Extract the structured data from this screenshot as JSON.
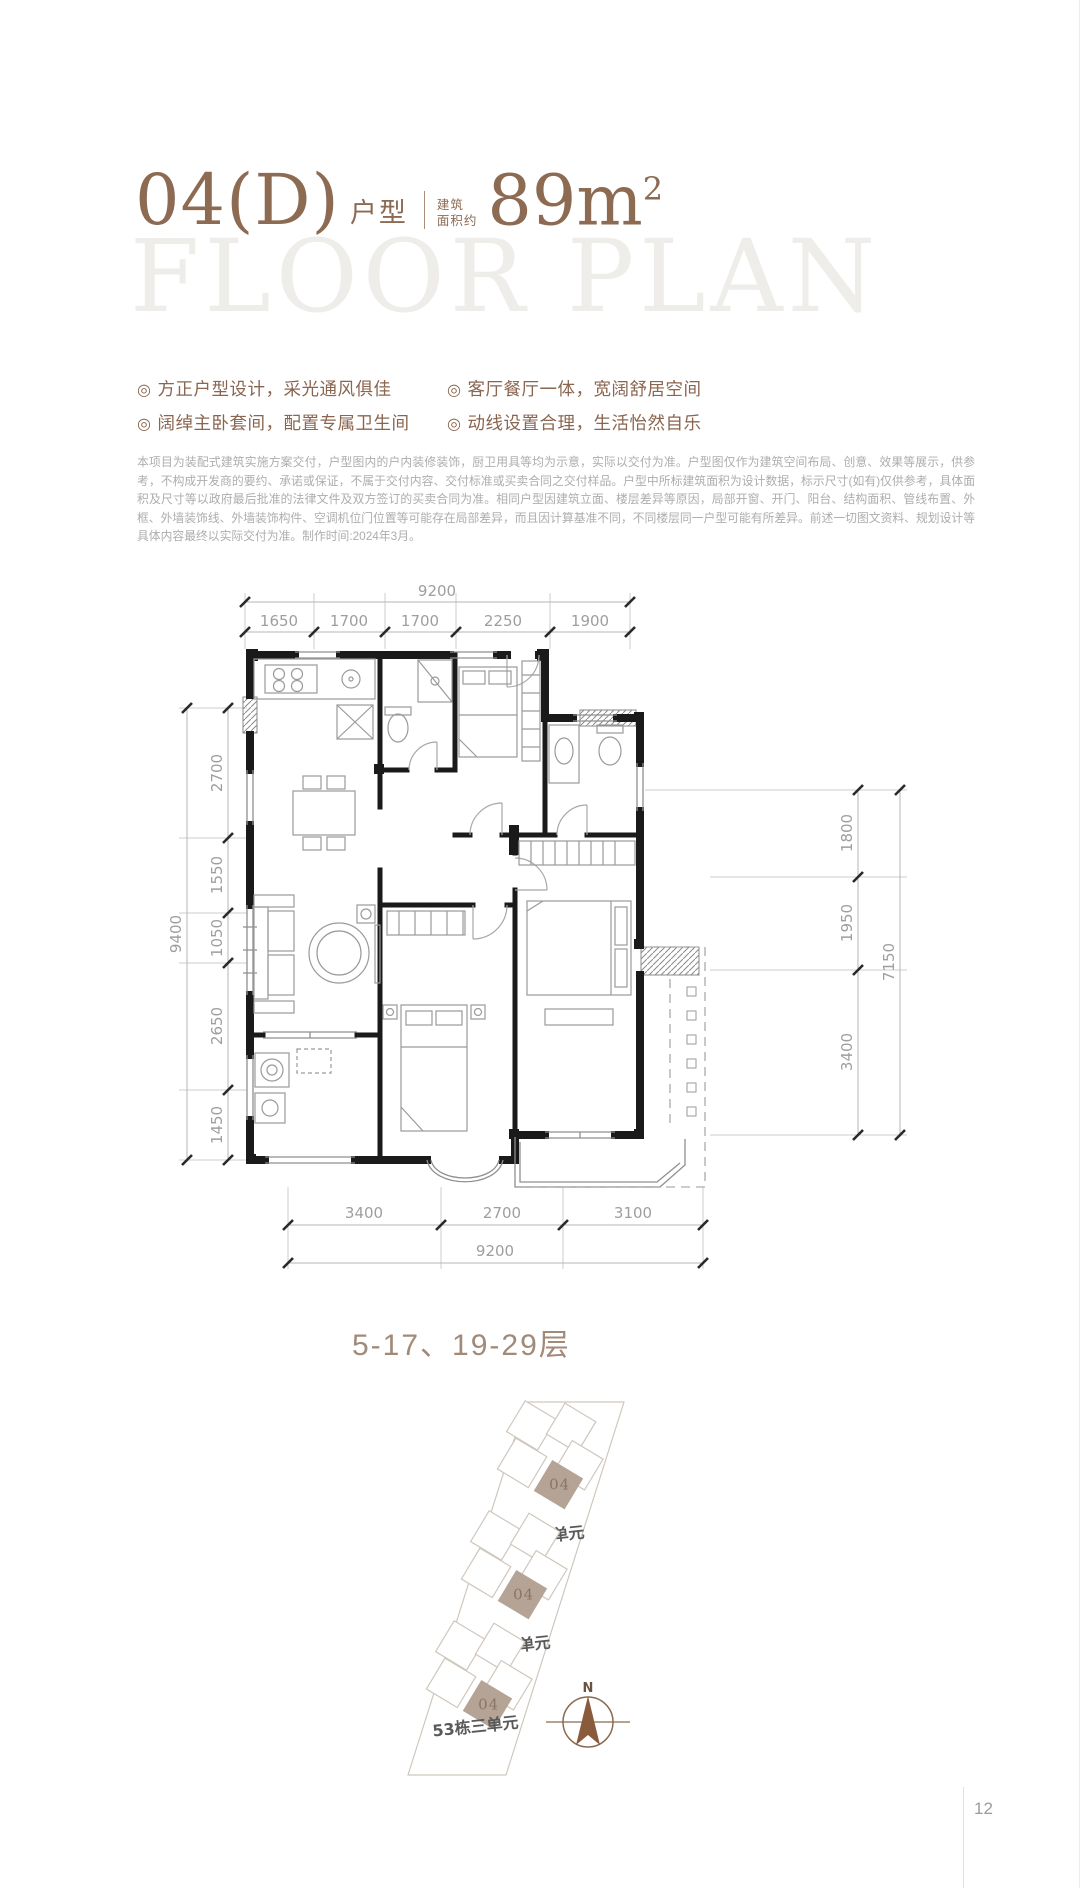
{
  "header": {
    "unit_code": "04(D)",
    "unit_type_label": "户型",
    "area_label_line1": "建筑",
    "area_label_line2": "面积约",
    "area_value": "89m",
    "area_superscript": "2"
  },
  "watermark": "FLOOR PLAN",
  "bullet_glyph": "◎",
  "features": [
    "方正户型设计，采光通风俱佳",
    "客厅餐厅一体，宽阔舒居空间",
    "阔绰主卧套间，配置专属卫生间",
    "动线设置合理，生活怡然自乐"
  ],
  "disclaimer": "本项目为装配式建筑实施方案交付，户型图内的户内装修装饰，厨卫用具等均为示意，实际以交付为准。户型图仅作为建筑空间布局、创意、效果等展示，供参考，不构成开发商的要约、承诺或保证，不属于交付内容、交付标准或买卖合同之交付样品。户型中所标建筑面积为设计数据，标示尺寸(如有)仅供参考，具体面积及尺寸等以政府最后批准的法律文件及双方签订的买卖合同为准。相同户型因建筑立面、楼层差异等原因，局部开窗、开门、阳台、结构面积、管线布置、外框、外墙装饰线、外墙装饰构件、空调机位门位置等可能存在局部差异，而且因计算基准不同，不同楼层同一户型可能有所差异。前述一切图文资料、规划设计等具体内容最终以实际交付为准。制作时间:2024年3月。",
  "dimensions": {
    "top": {
      "overall": "9200",
      "segments": [
        "1650",
        "1700",
        "1700",
        "2250",
        "1900"
      ]
    },
    "left": {
      "overall": "9400",
      "segments": [
        "2700",
        "1550",
        "1050",
        "2650",
        "1450"
      ]
    },
    "right": {
      "overall": "7150",
      "segments": [
        "1800",
        "1950",
        "3400"
      ]
    },
    "bottom": {
      "overall": "9200",
      "segments": [
        "3400",
        "2700",
        "3100"
      ]
    }
  },
  "floors_label": "5-17、19-29层",
  "site_plan": {
    "compass_label": "N",
    "units": [
      {
        "unit": "04",
        "caption": "53栋一单元"
      },
      {
        "unit": "04",
        "caption": "53栋二单元"
      },
      {
        "unit": "04",
        "caption": "53栋三单元"
      }
    ]
  },
  "page_number": "12",
  "colors": {
    "accent": "#8d6a52",
    "feature_text": "#8a6550",
    "watermark": "#efedea",
    "disclaimer_text": "#adadad",
    "dimension_text": "#9e9e9e",
    "wall": "#1a1a1a",
    "site_highlight": "#b5a496",
    "compass": "#8a5a3c"
  }
}
